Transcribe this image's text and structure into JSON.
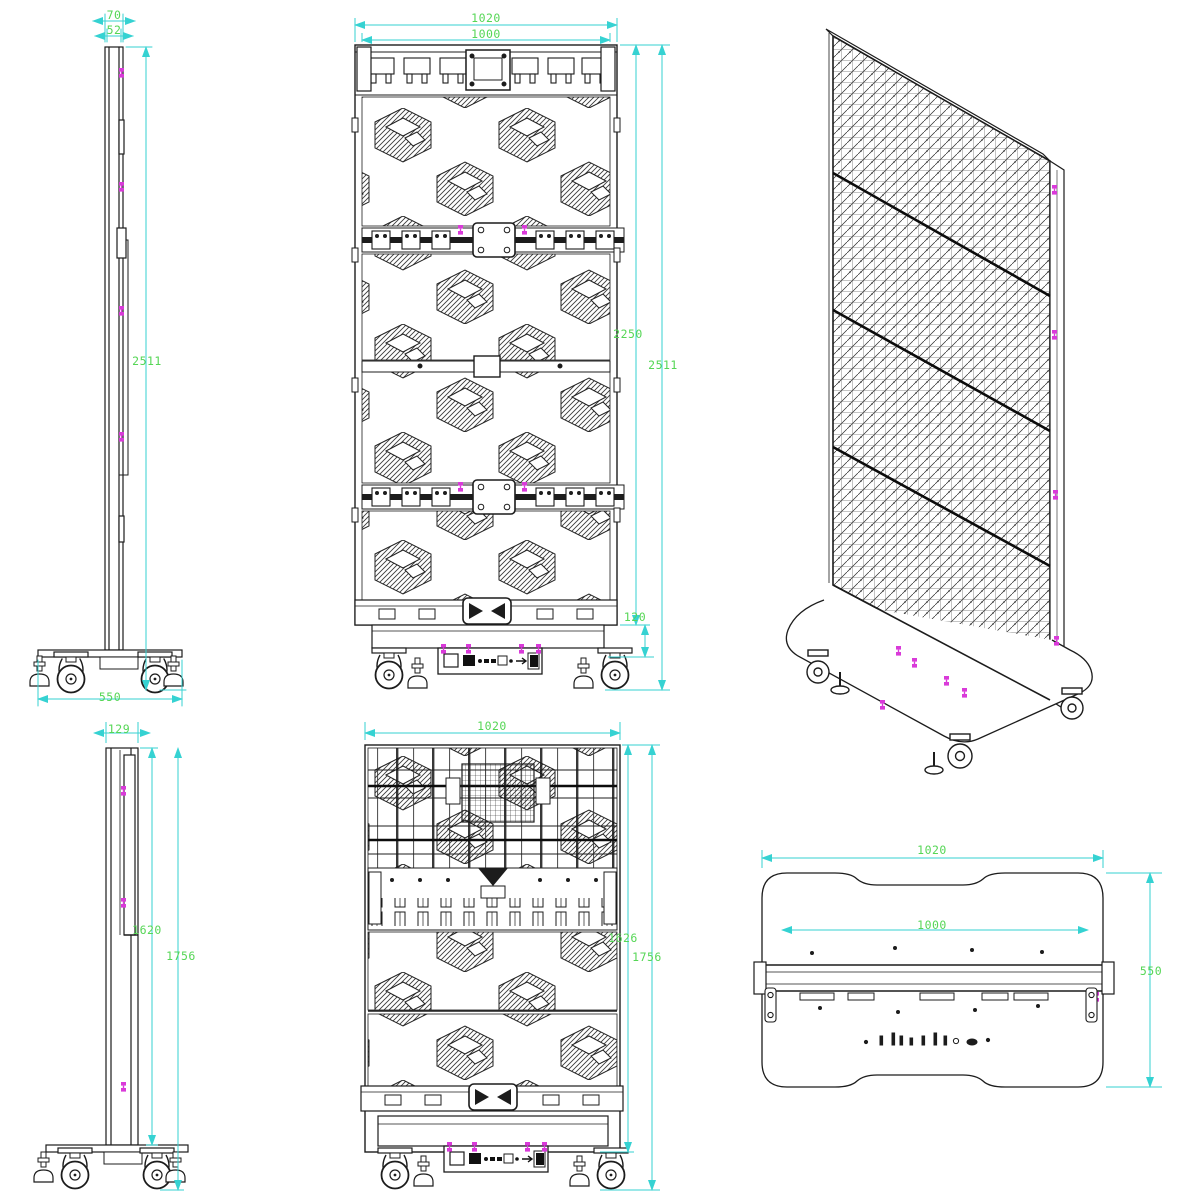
{
  "colors": {
    "drawing_line": "#1c1c1c",
    "dimension_line": "#35d2d2",
    "dimension_text": "#55d655",
    "fastener_marker": "#d93ad9",
    "background": "#ffffff"
  },
  "views": {
    "side_top": {
      "dims": {
        "thickness_outer": "70",
        "thickness_inner": "52",
        "total_height": "2511",
        "base_width": "550"
      }
    },
    "front_top": {
      "dims": {
        "outer_width": "1020",
        "inner_width": "1000",
        "screen_height": "2250",
        "total_height": "2511",
        "base_height": "120"
      }
    },
    "side_bottom": {
      "dims": {
        "thickness": "129",
        "panel_height": "1620",
        "total_height": "1756"
      }
    },
    "front_bottom": {
      "dims": {
        "outer_width": "1020",
        "panel_height": "1626",
        "total_height": "1756"
      }
    },
    "bottom_view": {
      "dims": {
        "plate_width": "1020",
        "inner_width": "1000",
        "plate_depth": "550"
      }
    }
  }
}
